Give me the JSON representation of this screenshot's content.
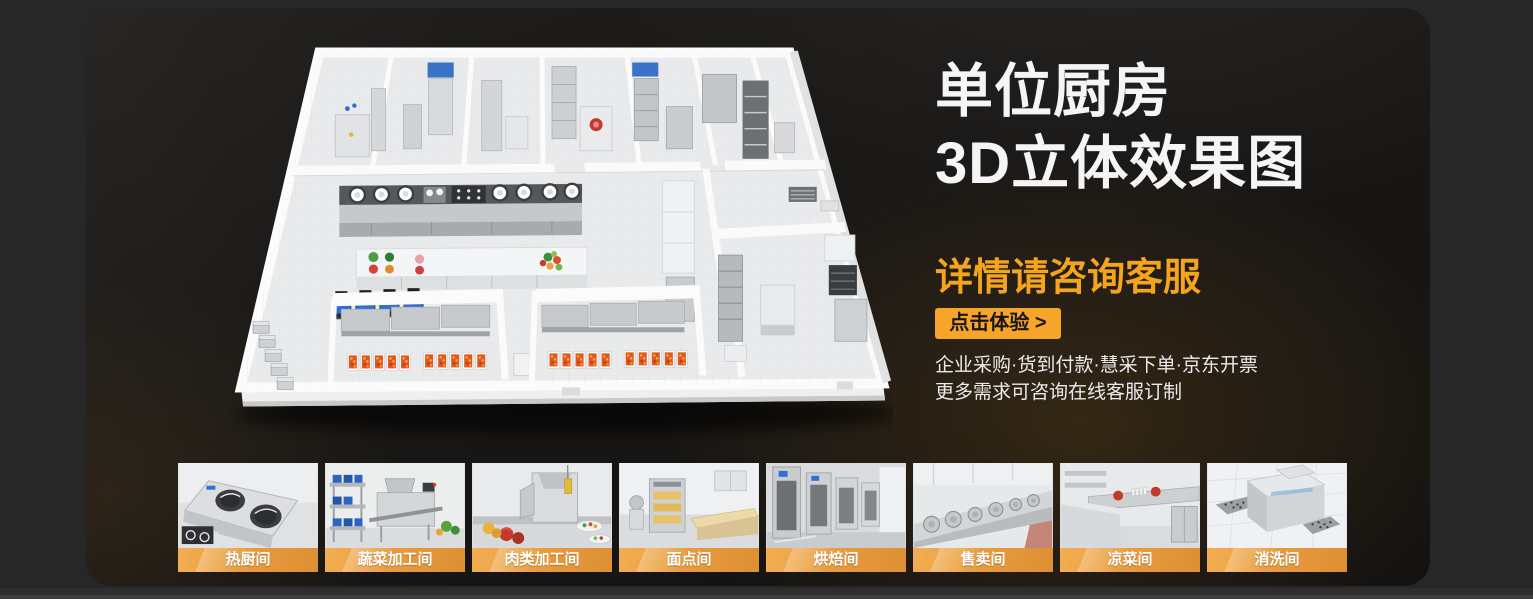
{
  "hero": {
    "title_line1": "单位厨房",
    "title_line2": "3D立体效果图",
    "subtitle": "详情请咨询客服",
    "cta_label": "点击体验 >",
    "bullets_line1": "企业采购·货到付款·慧采下单·京东开票",
    "bullets_line2": "更多需求可咨询在线客服订制",
    "illustration": "kitchen-floorplan-3d-render"
  },
  "colors": {
    "accent_orange": "#F6A52A",
    "label_gradient_start": "#F2AE52",
    "label_gradient_end": "#DD8F33",
    "card_background": "#1A1816",
    "page_background": "#272727",
    "title_white": "#F5F5F5"
  },
  "thumbnails": [
    {
      "label": "热厨间",
      "icon": "hot-kitchen-photo"
    },
    {
      "label": "蔬菜加工间",
      "icon": "vegetable-processing-photo"
    },
    {
      "label": "肉类加工间",
      "icon": "meat-processing-photo"
    },
    {
      "label": "面点间",
      "icon": "pastry-room-photo"
    },
    {
      "label": "烘焙间",
      "icon": "baking-room-photo"
    },
    {
      "label": "售卖间",
      "icon": "serving-room-photo"
    },
    {
      "label": "凉菜间",
      "icon": "cold-dish-room-photo"
    },
    {
      "label": "消洗间",
      "icon": "washing-room-photo"
    }
  ]
}
